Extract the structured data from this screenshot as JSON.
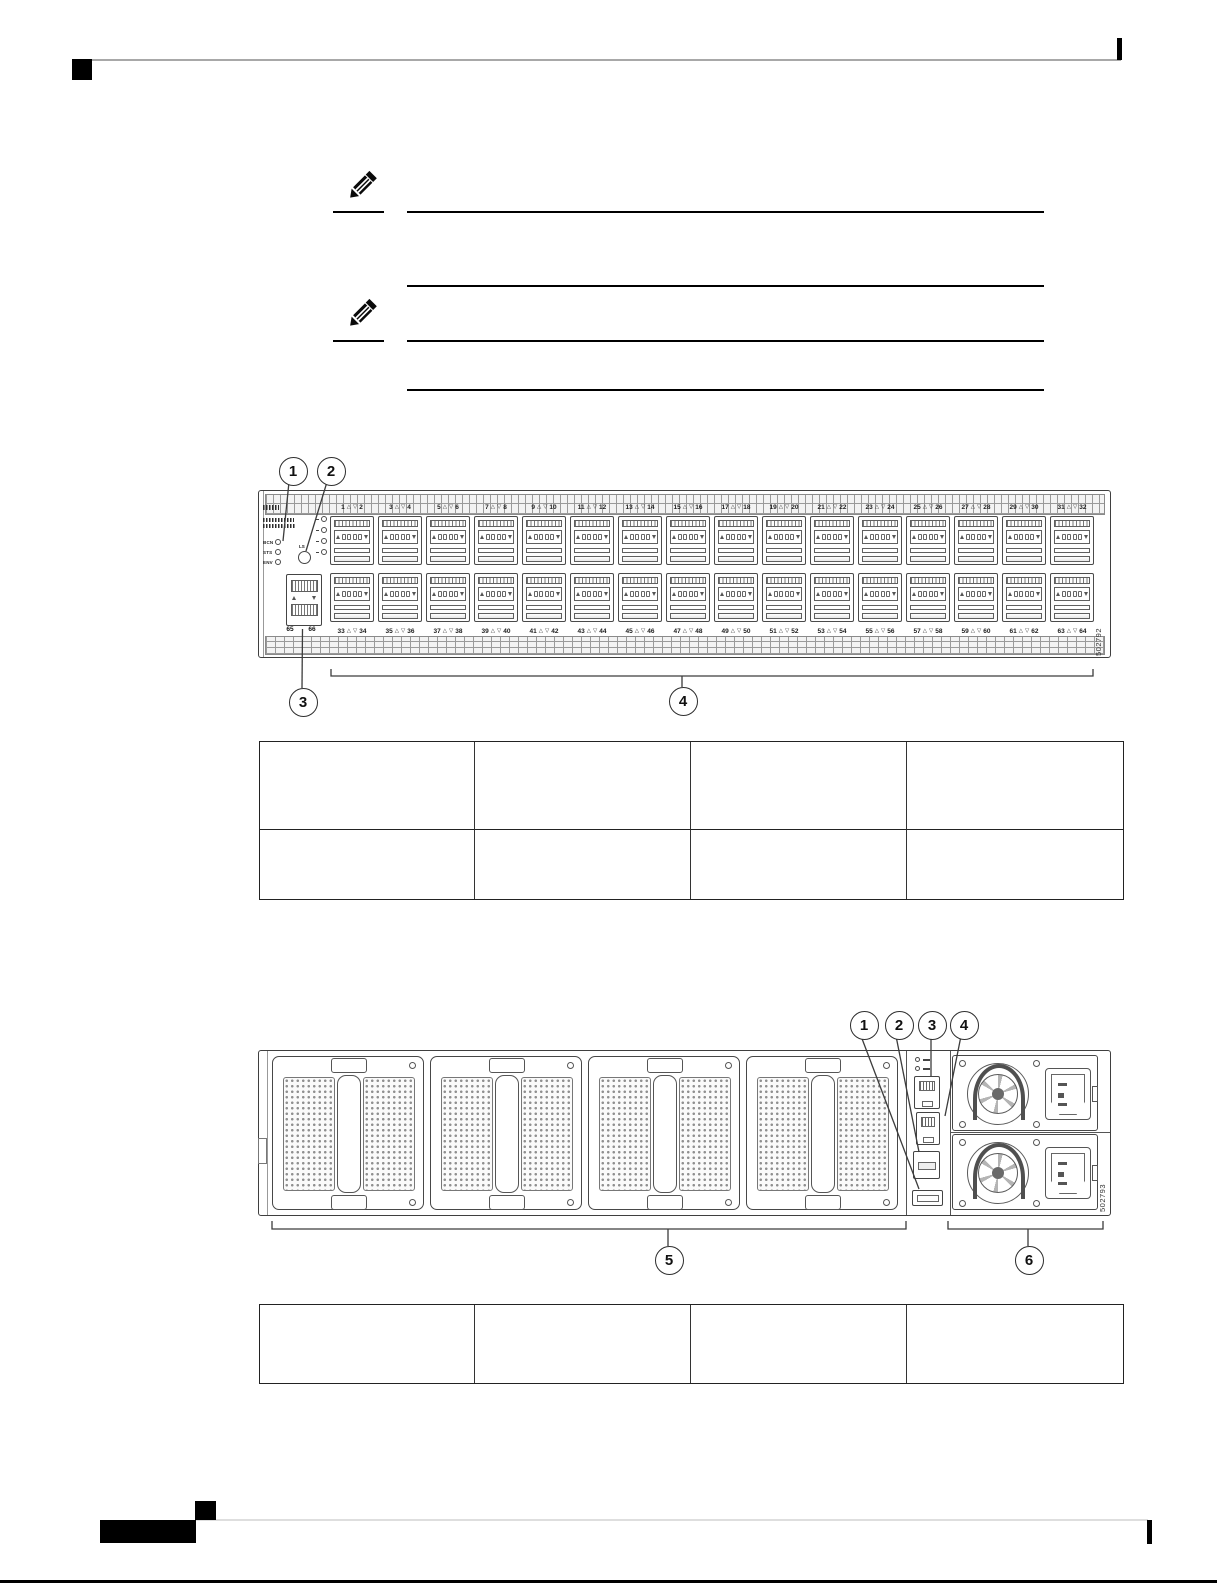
{
  "page": {
    "type": "hardware-guide-page",
    "colors": {
      "diagram_line": "#3f3f3f",
      "rule_black": "#000000",
      "rule_gray_top": "#a8a8a8",
      "rule_gray_footer": "#dedede",
      "table_border": "#222222"
    }
  },
  "notes": [
    {
      "icon": "pencil-note-icon"
    },
    {
      "icon": "pencil-note-icon"
    }
  ],
  "icons": {
    "triangle_up": "△",
    "triangle_down": "▽"
  },
  "front_panel": {
    "leds": [
      "BCN",
      "STS",
      "ENV"
    ],
    "ls_label": "LS",
    "mgmt_port_labels": [
      "65",
      "66"
    ],
    "figure_number": "502792",
    "callouts": [
      "1",
      "2",
      "3",
      "4"
    ],
    "port_pairs_top": [
      [
        "1",
        "2"
      ],
      [
        "3",
        "4"
      ],
      [
        "5",
        "6"
      ],
      [
        "7",
        "8"
      ],
      [
        "9",
        "10"
      ],
      [
        "11",
        "12"
      ],
      [
        "13",
        "14"
      ],
      [
        "15",
        "16"
      ],
      [
        "17",
        "18"
      ],
      [
        "19",
        "20"
      ],
      [
        "21",
        "22"
      ],
      [
        "23",
        "24"
      ],
      [
        "25",
        "26"
      ],
      [
        "27",
        "28"
      ],
      [
        "29",
        "30"
      ],
      [
        "31",
        "32"
      ]
    ],
    "port_pairs_bottom": [
      [
        "33",
        "34"
      ],
      [
        "35",
        "36"
      ],
      [
        "37",
        "38"
      ],
      [
        "39",
        "40"
      ],
      [
        "41",
        "42"
      ],
      [
        "43",
        "44"
      ],
      [
        "45",
        "46"
      ],
      [
        "47",
        "48"
      ],
      [
        "49",
        "50"
      ],
      [
        "51",
        "52"
      ],
      [
        "53",
        "54"
      ],
      [
        "55",
        "56"
      ],
      [
        "57",
        "58"
      ],
      [
        "59",
        "60"
      ],
      [
        "61",
        "62"
      ],
      [
        "63",
        "64"
      ]
    ]
  },
  "rear_panel": {
    "callouts": [
      "1",
      "2",
      "3",
      "4",
      "5",
      "6"
    ],
    "figure_number": "502793",
    "fan_module_count": 4,
    "psu_count": 2
  },
  "tables": {
    "upper": {
      "rows": [
        [
          "",
          "",
          "",
          ""
        ],
        [
          "",
          "",
          "",
          ""
        ]
      ]
    },
    "lower": {
      "rows": [
        [
          "",
          "",
          "",
          ""
        ]
      ]
    }
  }
}
